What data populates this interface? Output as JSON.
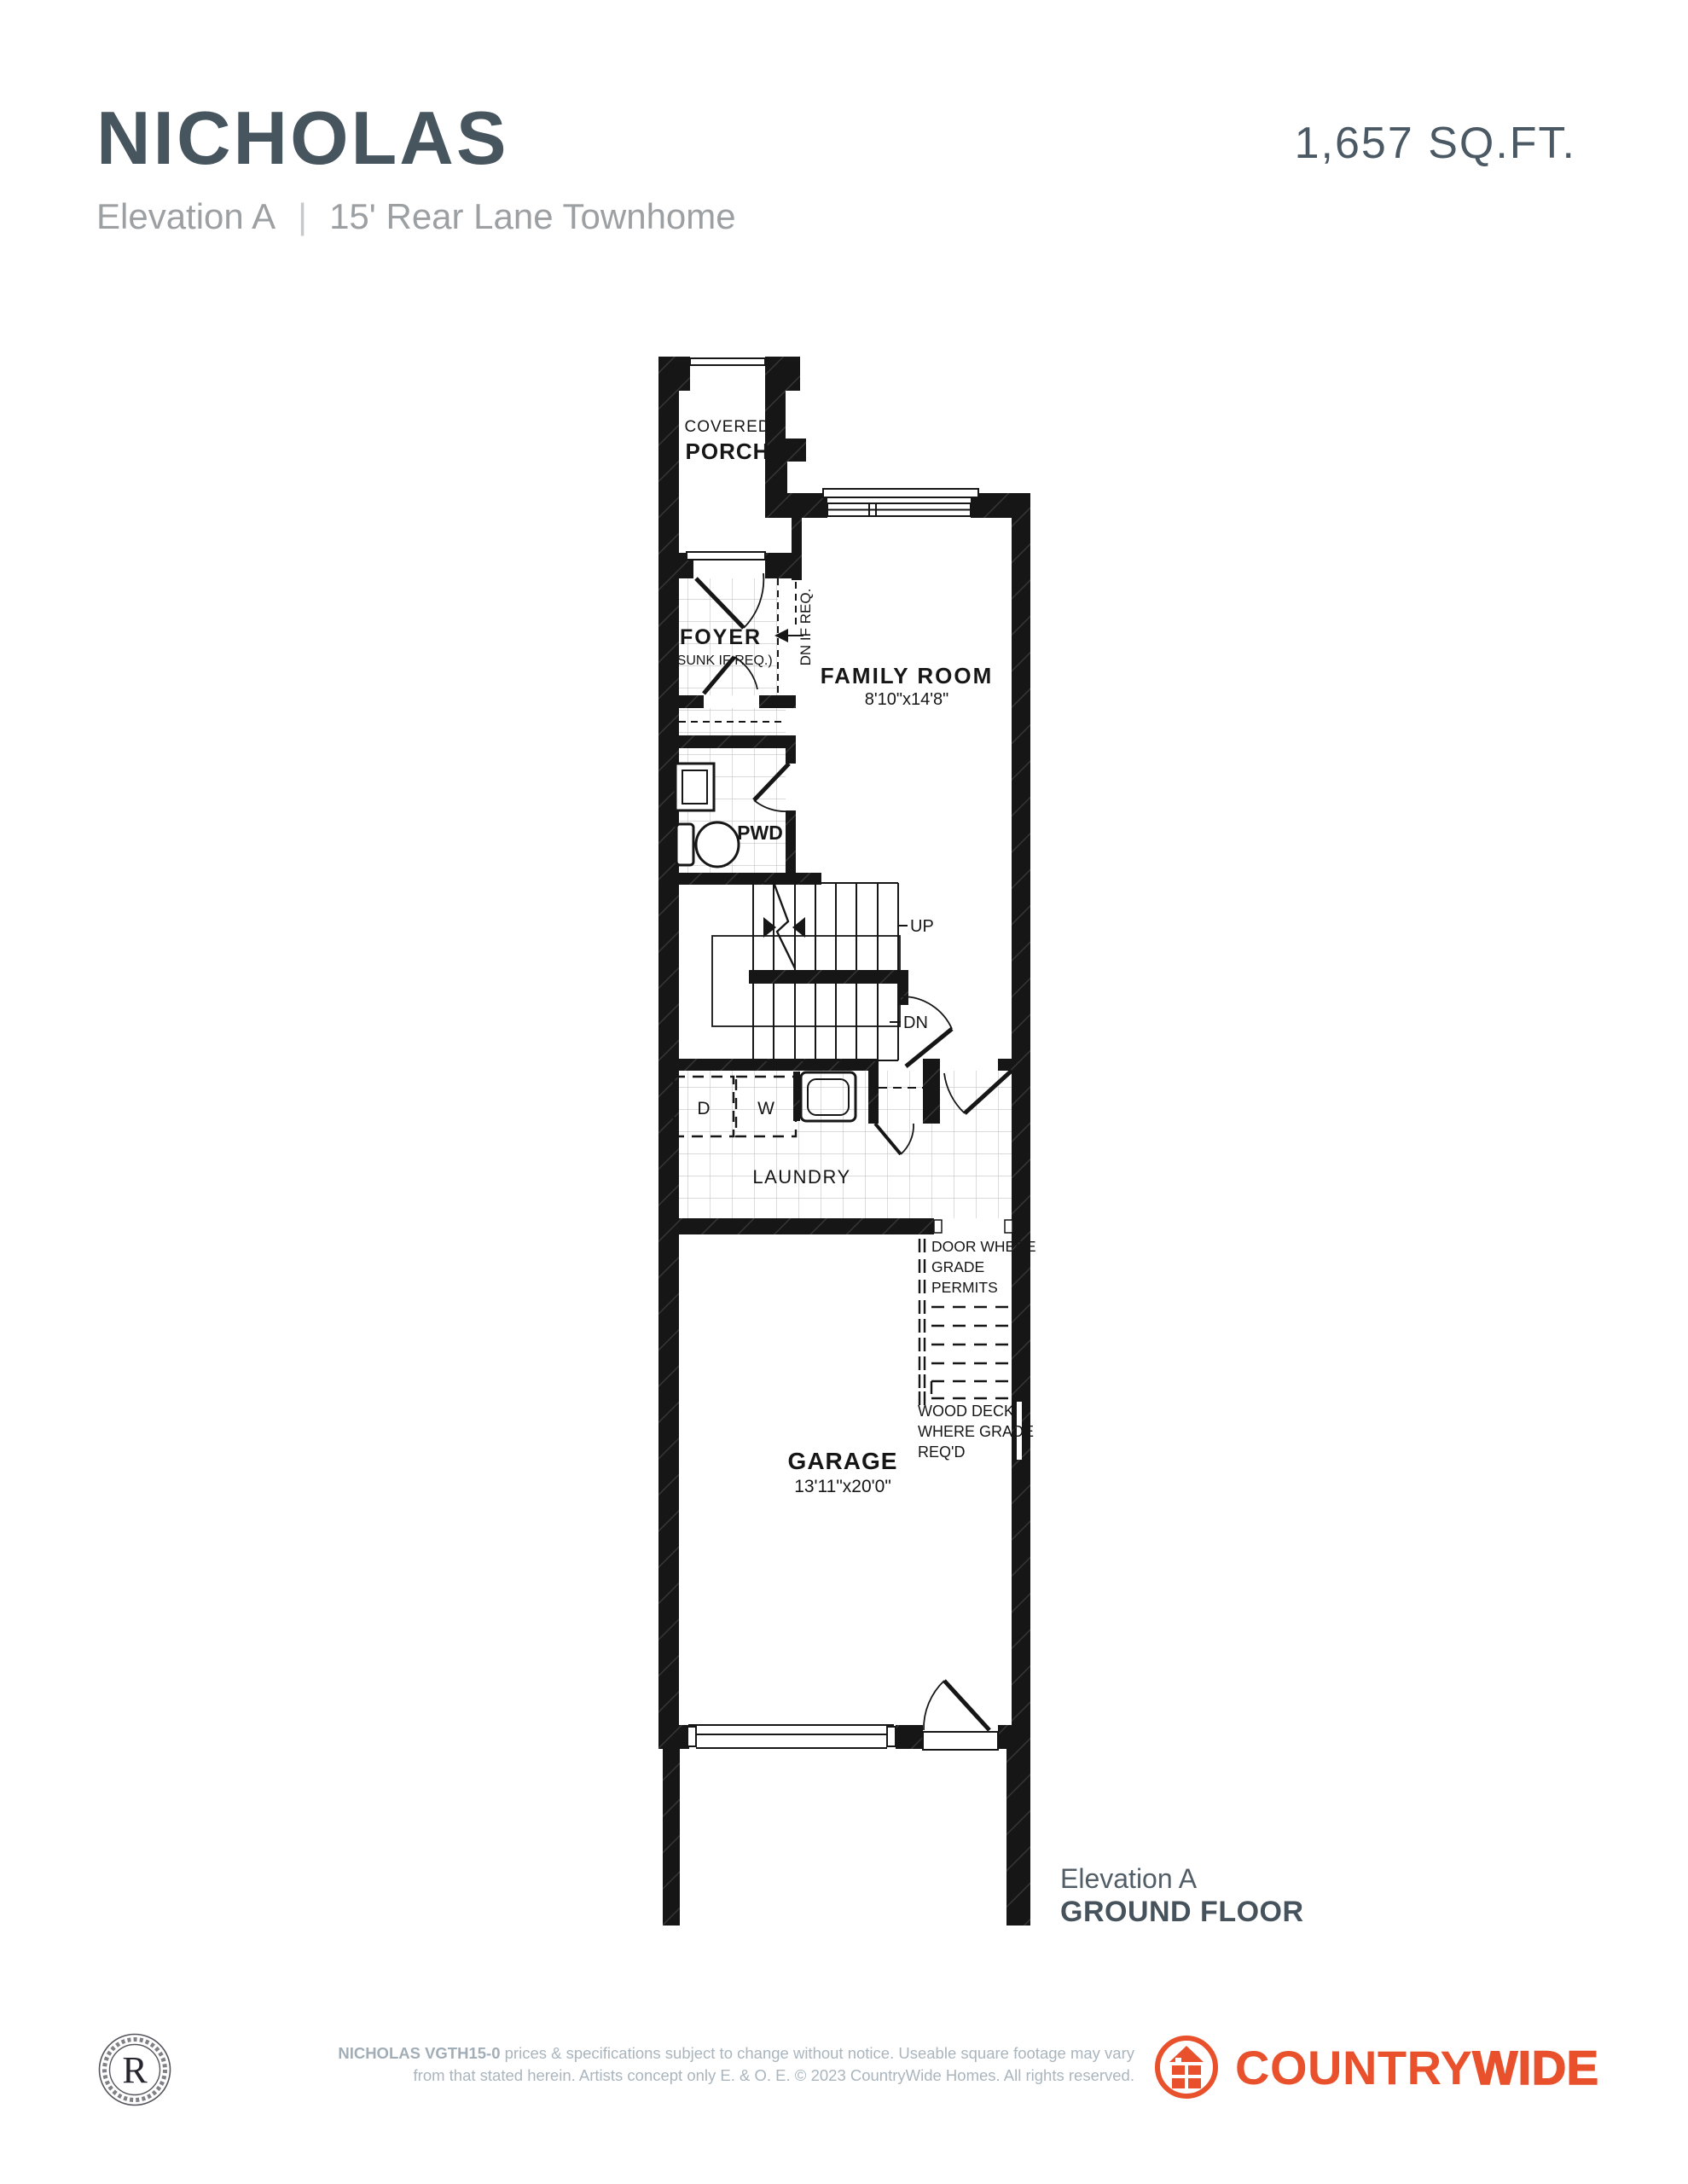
{
  "header": {
    "title": "NICHOLAS",
    "elevation": "Elevation A",
    "separator": "|",
    "subtitle": "15' Rear Lane Townhome",
    "sqft": "1,657 SQ.FT."
  },
  "plan": {
    "covered": "COVERED",
    "porch": "PORCH",
    "foyer": "FOYER",
    "foyer_note": "(SUNK IF REQ.)",
    "dn_if_req": "DN IF REQ.",
    "family_room": "FAMILY ROOM",
    "family_room_dims": "8'10\"x14'8\"",
    "pwd": "PWD",
    "up": "UP",
    "dn": "DN",
    "dryer": "D",
    "washer": "W",
    "laundry": "LAUNDRY",
    "door_grade_line1": "DOOR WHERE",
    "door_grade_line2": "GRADE",
    "door_grade_line3": "PERMITS",
    "wood_deck_line1": "WOOD DECK",
    "wood_deck_line2": "WHERE GRADE",
    "wood_deck_line3": "REQ'D",
    "garage": "GARAGE",
    "garage_dims": "13'11\"x20'0\""
  },
  "caption": {
    "elevation": "Elevation A",
    "floor": "GROUND FLOOR"
  },
  "footer": {
    "seal_letter": "R",
    "disclaimer_bold": "NICHOLAS VGTH15-0",
    "disclaimer_rest_line1": " prices & specifications subject to change without notice. Useable square footage may vary",
    "disclaimer_line2": "from that stated herein. Artists concept only E. & O. E. © 2023 CountryWide Homes. All rights reserved.",
    "brand_part1": "COUNTRY",
    "brand_part2": "WIDE"
  },
  "colors": {
    "title_slate": "#47555f",
    "subtitle_gray": "#9ca0a3",
    "caption_slate": "#4e5a63",
    "footer_gray": "#aab5bd",
    "brand_orange": "#e8512c",
    "plan_ink": "#161616"
  }
}
